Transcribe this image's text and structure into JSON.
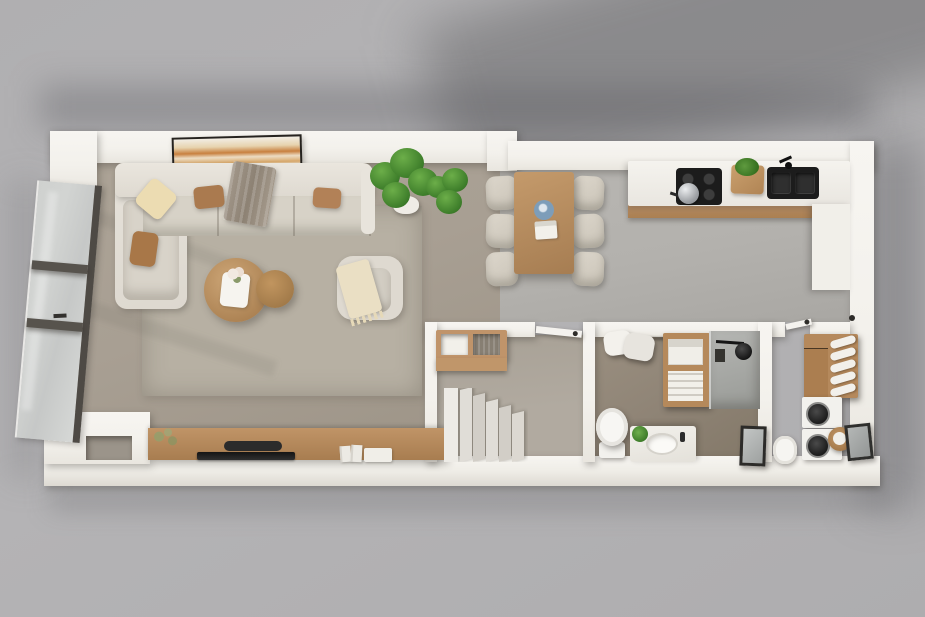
{
  "scene": {
    "description": "3D rendered top-down floor plan of a one-bedroom apartment on a gray studio backdrop",
    "style": "photoreal architectural visualization, soft cast shadows, no visible text",
    "text_visible": []
  },
  "palette": {
    "bg": "#b2b1b3",
    "bgShadow": "#8f8f93",
    "wall": "#f3f1ec",
    "wallShade": "#e3dfd8",
    "floorLiving": "#a89f93",
    "floorKitchen": "#b3b1ad",
    "floorHall": "#b1aaa0",
    "floorBath": "#8f8476",
    "floorLaundry": "#988d7f",
    "rug": "#b7b0a3",
    "wood": "#c0946a",
    "woodDark": "#a67d52",
    "sofa": "#e3dfd7",
    "cushion": "#d7d2c7",
    "black": "#1c1c1c",
    "steel": "#b9bcbf",
    "glass": "#d2d4d2",
    "frameDark": "#4e4a45",
    "plant": "#4c8a33",
    "plantDark": "#2f6b22",
    "plateBlue": "#7d9db9",
    "pillowBrown": "#aa7a4f",
    "pillowCream": "#ecdcb2",
    "throw": "#9d9183",
    "white": "#f4f2ee"
  },
  "rooms": {
    "living": {
      "label": "Living room",
      "furniture": [
        "L-shaped sectional sofa",
        "cream throw pillow",
        "two brown throw pillows",
        "tan throw pillow",
        "taupe throw blanket",
        "large area rug",
        "round wooden coffee table",
        "round wooden side table",
        "white decor tray with flowers",
        "cream armchair with fringed throw",
        "abstract wall art in orange tones",
        "floor-to-ceiling window wall with dark frames",
        "wooden media console",
        "flat TV panel",
        "soundbar",
        "decorative plant",
        "books",
        "white storage box"
      ]
    },
    "dining": {
      "label": "Dining area",
      "furniture": [
        "rectangular wooden dining table",
        "six upholstered dining chairs",
        "blue plate",
        "white papers",
        "two potted green plants"
      ]
    },
    "kitchen": {
      "label": "Kitchen",
      "furniture": [
        "straight white counter with wooden base",
        "black cooktop with four burners",
        "steel pot",
        "wooden cutting board with herbs",
        "black double sink with faucet",
        "white counter return cabinet"
      ]
    },
    "hall": {
      "label": "Hallway with staircase",
      "furniture": [
        "wall-mounted wooden shelf",
        "white storage box",
        "wicker basket",
        "staircase with light treads",
        "interior door"
      ]
    },
    "bath": {
      "label": "Bathroom",
      "furniture": [
        "hanging white towels",
        "wooden towel shelf",
        "walk-in shower with black shower head",
        "white toilet",
        "vanity with oval sink and black faucet",
        "small green plant",
        "dark leaning mirror"
      ]
    },
    "laundry": {
      "label": "Laundry room",
      "furniture": [
        "wooden towel rack with rolled towels",
        "drawer cabinet",
        "stacked washer and dryer",
        "rattan basket with towel",
        "white toilet",
        "dark leaning mirror",
        "interior door"
      ]
    }
  }
}
